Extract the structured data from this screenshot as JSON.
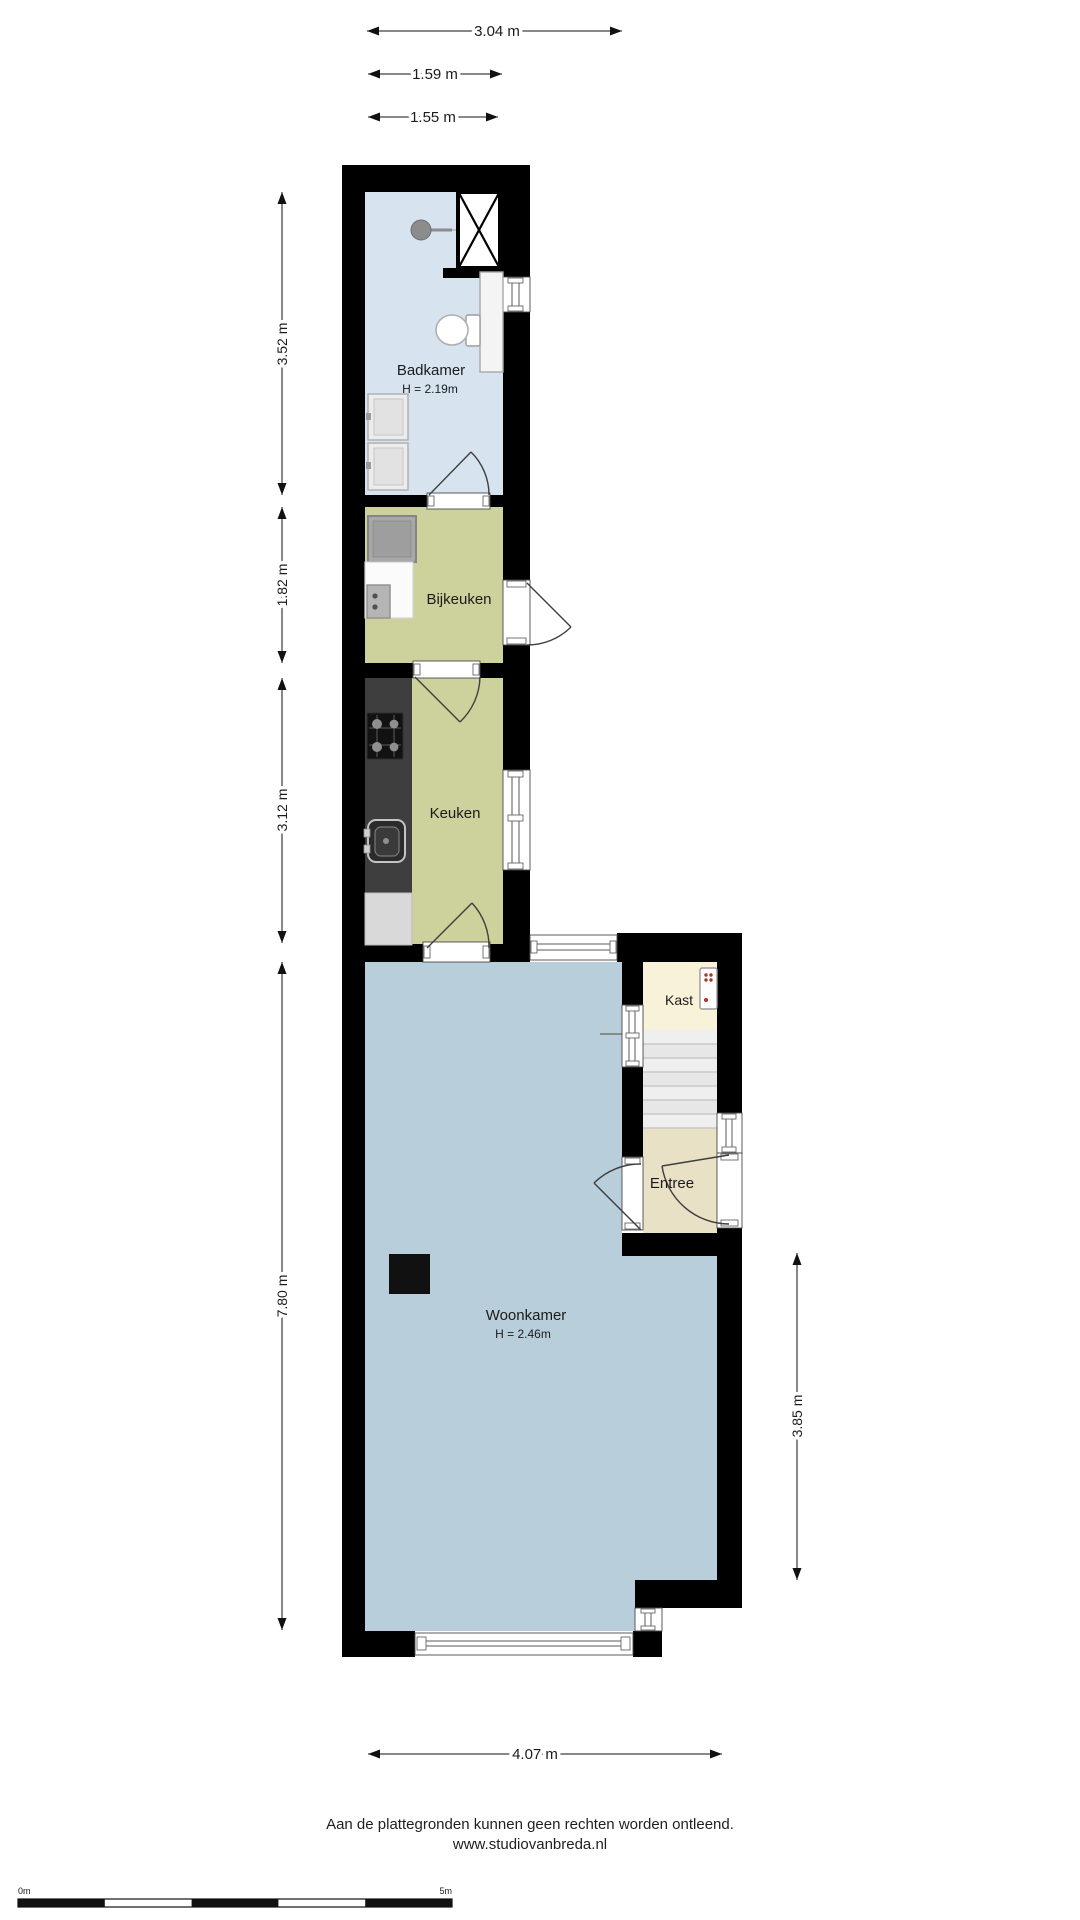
{
  "colors": {
    "wall": "#000000",
    "badkamer_floor": "#d7e4f0",
    "kitchen_floor": "#cdd19b",
    "woonkamer_floor": "#b9cedb",
    "kast_floor": "#f7f2d8",
    "entree_floor": "#e8e1c6",
    "stairs_floor": "#efefef",
    "counter_dark": "#3e3e3e",
    "fixture_gray": "#a8a8a8"
  },
  "rooms": {
    "badkamer": {
      "label": "Badkamer",
      "height": "H = 2.19m"
    },
    "bijkeuken": {
      "label": "Bijkeuken"
    },
    "keuken": {
      "label": "Keuken"
    },
    "kast": {
      "label": "Kast"
    },
    "entree": {
      "label": "Entree"
    },
    "woonkamer": {
      "label": "Woonkamer",
      "height": "H = 2.46m"
    }
  },
  "dimensions": {
    "top": [
      "3.04 m",
      "1.59 m",
      "1.55 m"
    ],
    "left": [
      "3.52 m",
      "1.82 m",
      "3.12 m",
      "7.80 m"
    ],
    "right": [
      "3.85 m"
    ],
    "bottom": [
      "4.07 m"
    ]
  },
  "footer": {
    "disclaimer": "Aan de plattegronden kunnen geen rechten worden ontleend.",
    "website": "www.studiovanbreda.nl"
  },
  "scale_bar": {
    "start_label": "0m",
    "end_label": "5m"
  }
}
